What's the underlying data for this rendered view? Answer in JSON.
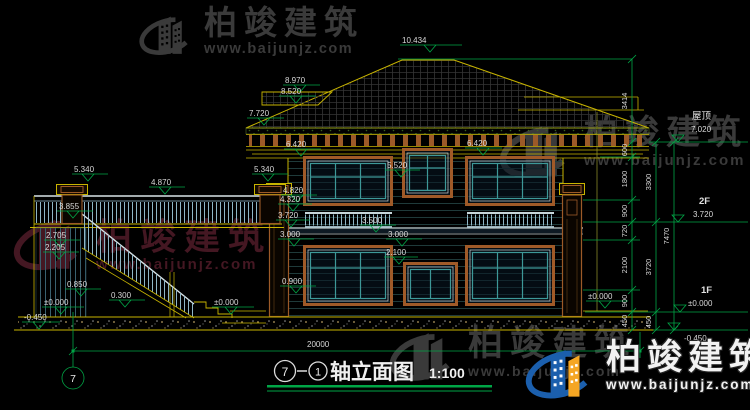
{
  "watermark": {
    "brand": "柏竣建筑",
    "url": "www.baijunjz.com"
  },
  "title": {
    "axis_a": "7",
    "dash": "—",
    "axis_b": "1",
    "name": "轴立面图",
    "scale": "1:100"
  },
  "axis": {
    "bubble": "7"
  },
  "dims": {
    "total": "20000",
    "chain1": [
      "3414",
      "600",
      "1800",
      "900",
      "720",
      "2100",
      "900",
      "450"
    ],
    "chain2": [
      "3300",
      "3720",
      "450"
    ],
    "chain3": [
      "7470"
    ]
  },
  "levels": {
    "e10434": "10.434",
    "e8970": "8.970",
    "e8520": "8.520",
    "e7720": "7.720",
    "e6420": "6.420",
    "e5520": "5.520",
    "e5340": "5.340",
    "e4870": "4.870",
    "e4820": "4.820",
    "e4320": "4.320",
    "e3855": "3.855",
    "e3720": "3.720",
    "e3500": "3.500",
    "e3000": "3.000",
    "e2705": "2.705",
    "e2205": "2.205",
    "e2100": "2.100",
    "e0900": "0.900",
    "e0850": "0.850",
    "e0300": "0.300",
    "zero": "±0.000",
    "neg": "-0.450"
  },
  "annot": {
    "roof_label": "屋顶",
    "roof_elev": "7.020",
    "f2": "2F",
    "f2_elev": "3.720",
    "f1": "1F",
    "f1_elev": "±0.000",
    "base": "-0.450"
  }
}
